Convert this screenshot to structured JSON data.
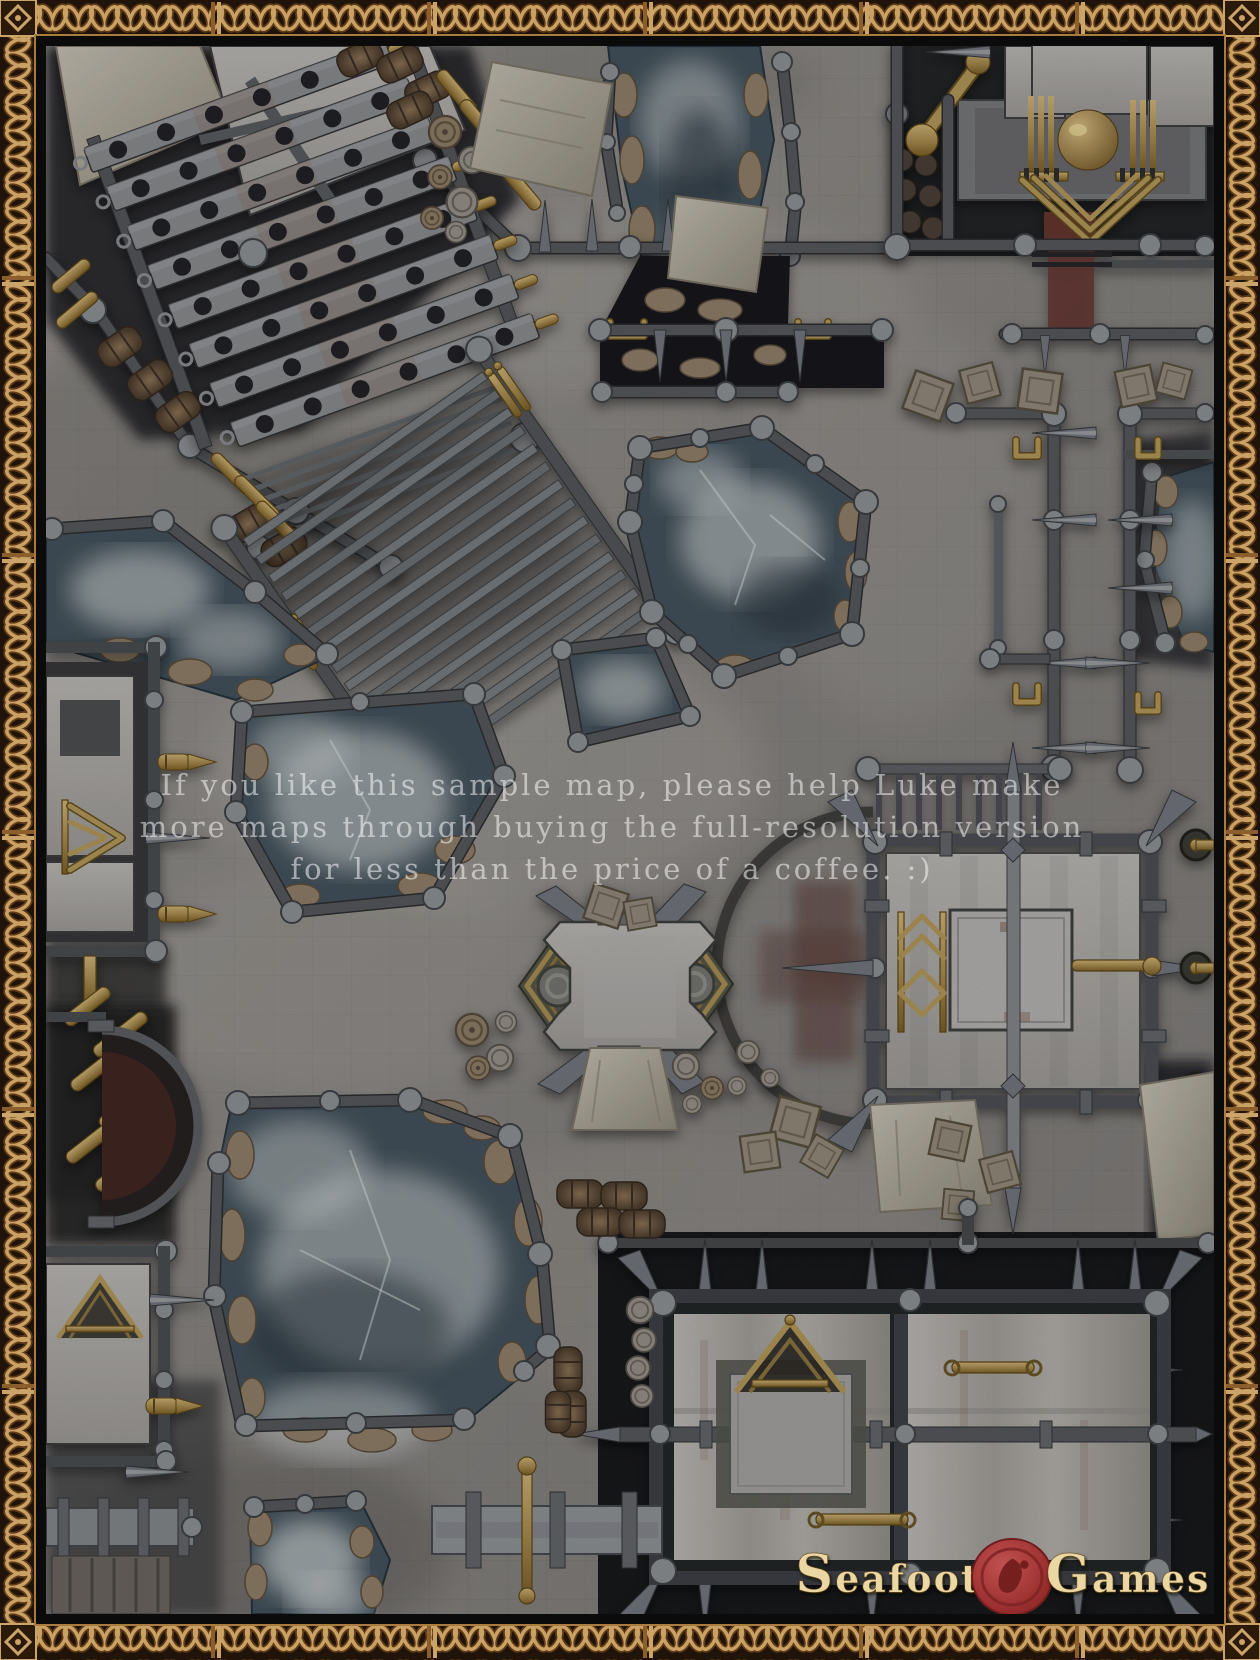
{
  "watermark": {
    "line1": "If you like this sample map, please help Luke make",
    "line2": "more maps through buying the full-resolution version",
    "line3": "for less than the price of a coffee. :)"
  },
  "branding": {
    "word1_initial": "S",
    "word1_rest": "eafoot",
    "word2_initial": "G",
    "word2_rest": "ames",
    "seal_icon": "footprint-wax-seal"
  },
  "palette": {
    "border_gold": "#c9a164",
    "border_dark": "#20130a",
    "frame_black": "#0b0b0b",
    "stone": "#8d8a86",
    "wall": "#4a4d51",
    "ice": "#44525c",
    "fog": "#ccd1d1",
    "brass": "#a5894d",
    "wax_red": "#9e3030",
    "carpet_red": "#66352f",
    "tarp": "#b3ada0",
    "rock": "#8f7f68"
  },
  "features": [
    "celtic-knot-border",
    "slatted-bridge",
    "diagonal-staircase",
    "frozen-pools",
    "spiked-walls",
    "steam-machine",
    "central-x-platform",
    "square-ritual-platform",
    "storage-building",
    "barrels",
    "crates",
    "canvas-tarps",
    "brass-pipes"
  ]
}
